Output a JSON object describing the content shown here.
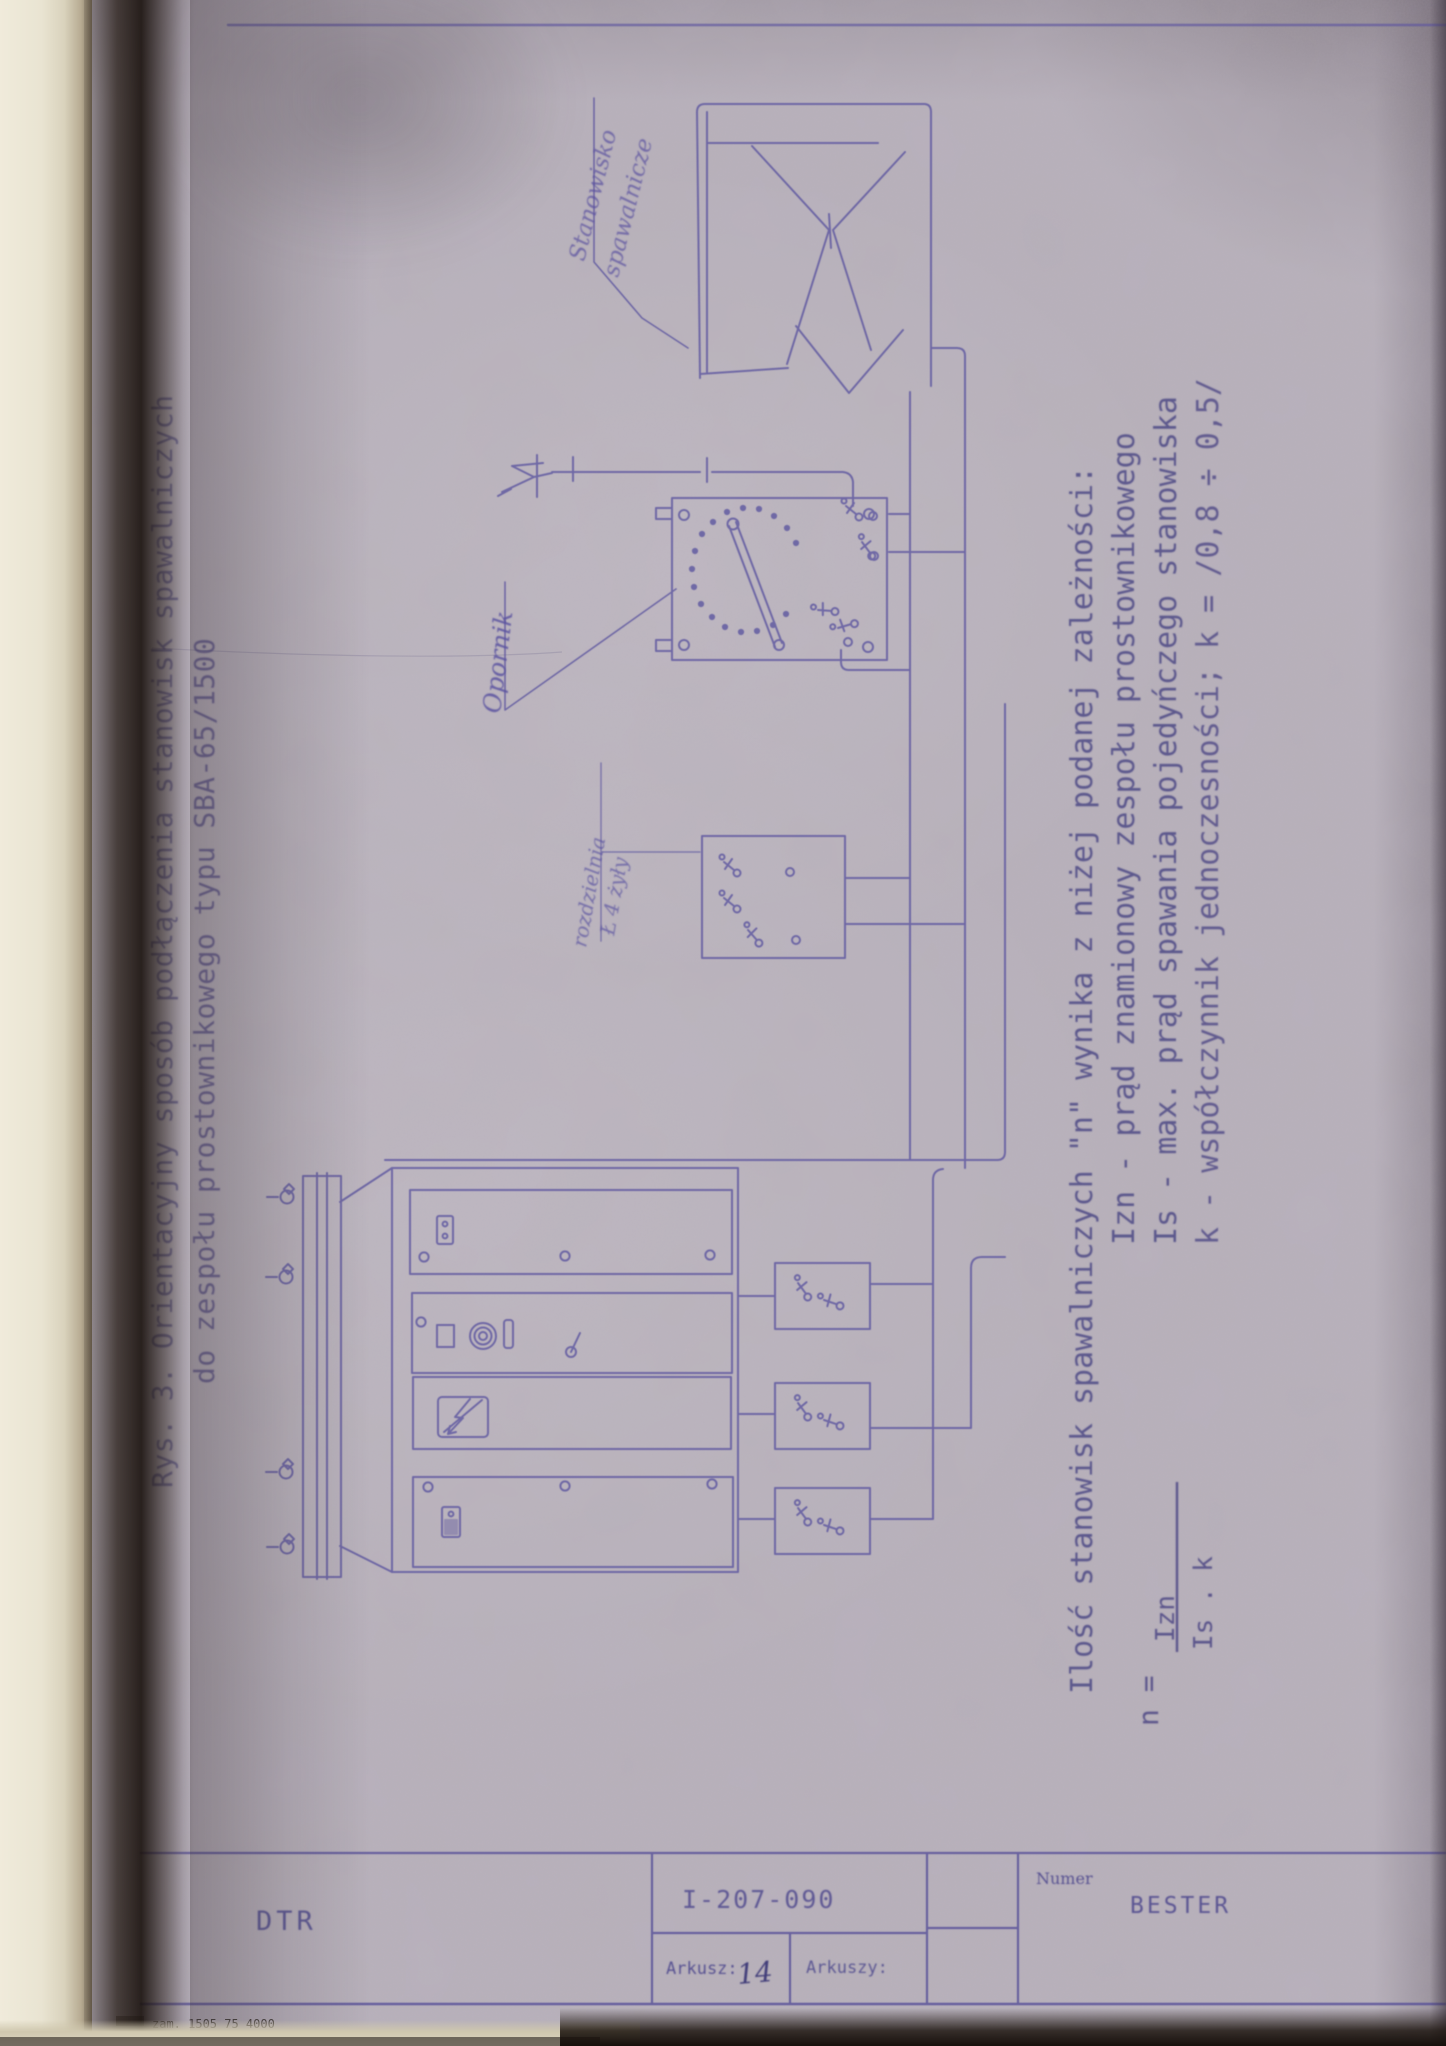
{
  "document": {
    "figure_title_line1": "Rys. 3. Orientacyjny sposób podłączenia stanowisk spawalniczych",
    "figure_title_line2": "do zespołu prostownikowego typu SBA-65/1500",
    "notes_line1": "Ilość stanowisk spawalniczych \"n\" wynika z niżej podanej zależności:",
    "notes_line2": "Izn - prąd znamionowy zespołu prostownikowego",
    "notes_line3": "Is  - max. prąd spawania pojedyńczego stanowiska",
    "notes_line4": "k   - współczynnik jednoczesności; k = /0,8 ÷ 0,5/",
    "formula_lhs": "n =",
    "formula_numerator": "Izn",
    "formula_denominator": "Is . k",
    "label_station_line1": "Stanowisko",
    "label_station_line2": "spawalnicze",
    "label_resistor": "Opornik",
    "label_distribution_line1": "rozdzielnia",
    "label_distribution_line2": "Ł 4 żyły",
    "titleblock": {
      "dtr": "DTR",
      "doc_number": "I-207-090",
      "numer_label": "Numer",
      "brand": "BESTER",
      "arkusz_label": "Arkusz:",
      "arkusz_value": "14",
      "arkuszy_label": "Arkuszy:",
      "print_note": "zam. 1505 75 4000"
    },
    "ink_color": "#5f58a0",
    "typed_color": "#4a4489"
  }
}
